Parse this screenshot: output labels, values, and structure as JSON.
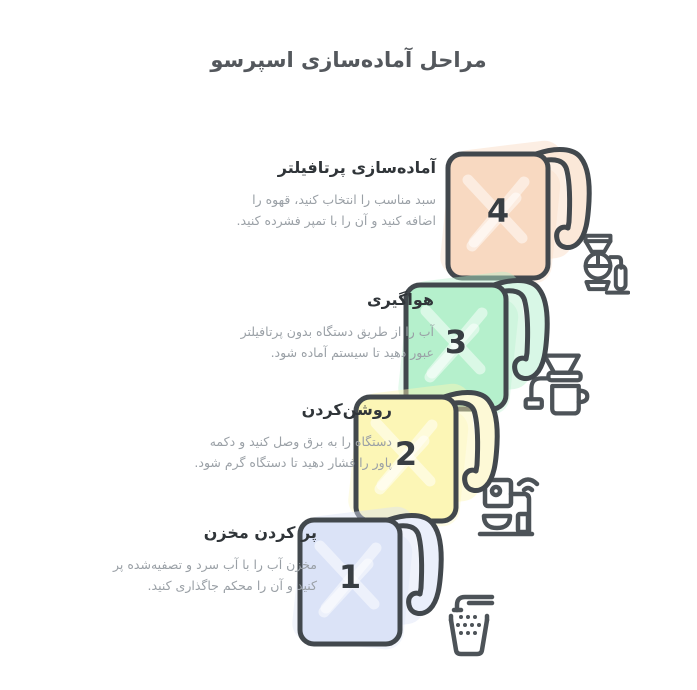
{
  "title": "مراحل آماده‌سازی اسپرسو",
  "steps": [
    {
      "number": "1",
      "heading": "پر کردن مخزن",
      "description": "مخزن آب را با آب سرد و تصفیه‌شده پر کنید و آن را محکم جاگذاری کنید.",
      "color": "#dbe3f7",
      "color_light": "#eaeffb",
      "icon": "faucet-filling-cup-icon"
    },
    {
      "number": "2",
      "heading": "روشن‌کردن",
      "description": "دستگاه را به برق وصل کنید و دکمه پاور را فشار دهید تا دستگاه گرم شود.",
      "color": "#fcf6b6",
      "color_light": "#fdf9d6",
      "icon": "espresso-machine-power-icon"
    },
    {
      "number": "3",
      "heading": "هواگیری",
      "description": "آب را از طریق دستگاه بدون پرتافیلتر عبور دهید تا سیستم آماده شود.",
      "color": "#b5f0cc",
      "color_light": "#d8f7e6",
      "icon": "dripper-over-mug-icon"
    },
    {
      "number": "4",
      "heading": "آماده‌سازی پرتافیلتر",
      "description": "سبد مناسب را انتخاب کنید، قهوه را اضافه کنید و آن را با تمپر فشرده کنید.",
      "color": "#f8d9c1",
      "color_light": "#fbe8d8",
      "icon": "portafilter-siphon-icon"
    }
  ],
  "colors": {
    "outline": "#42484d",
    "number_text": "#383e43",
    "title_text": "#54585d",
    "heading_text": "#303539",
    "body_text": "#9aa0a6",
    "icon_stroke": "#4d5358",
    "background": "#ffffff"
  }
}
